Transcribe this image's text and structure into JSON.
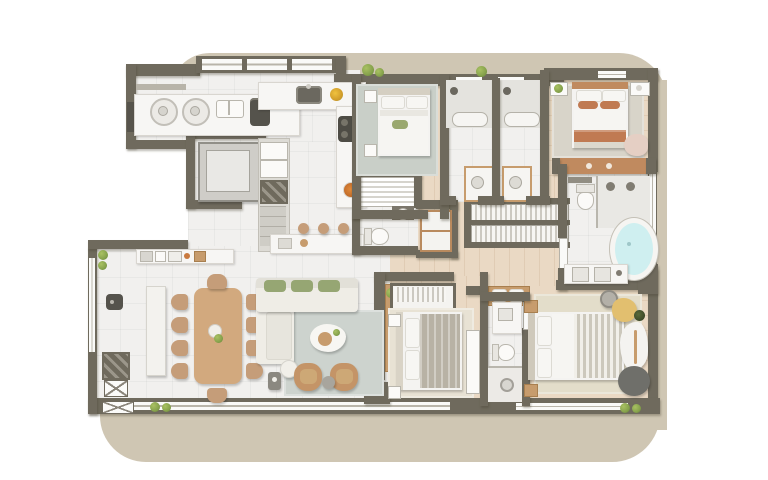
{
  "scene": {
    "type": "architectural-floor-plan",
    "view": "top-down 3d render",
    "description": "Rendered apartment floor plan on a beige rounded-corner backdrop",
    "visible_text": "none"
  },
  "palette": {
    "page_bg": "#ffffff",
    "card": "#cfc6b3",
    "wall": "#6f6a5d",
    "wall_dark": "#57544c",
    "floor_tile": "#f1f0ee",
    "wood": "#ead9c4",
    "counter": "#f7f6f4",
    "counter_line": "#d9d6d0",
    "glass": "#fafaf8",
    "window_frame": "#b9b5aa",
    "rug_gray": "#c9cfc8",
    "rug_warm": "#d8d4c9",
    "rug_beige": "#e3ddca",
    "rug_light": "#e8e2d4",
    "rug_living": "#cdd3ce",
    "sofa": "#efede6",
    "cushion_green": "#96a673",
    "wood_furn": "#d2a97e",
    "chair_tan": "#c59d79",
    "armchair": "#c49467",
    "terracotta": "#c07a52",
    "linen_white": "#f4f3f1",
    "blanket_gray": "#b8b2a5",
    "tub_water": "#cfeff0",
    "pouf_yellow": "#e2bf6f",
    "plant": "#86a24c",
    "plant_dark": "#5f7d35",
    "appliance_dark": "#55534c",
    "elevator": "#cfcdc8",
    "elevator_inner": "#e9e8e5",
    "blush": "#e5cfc4",
    "ottoman_dark": "#6f6f6a",
    "headboard_wood": "#c08a5f"
  },
  "rooms": [
    {
      "id": "laundry-service",
      "furniture": [
        "windows",
        "counter",
        "two washing machines",
        "utility sink",
        "dark appliance"
      ]
    },
    {
      "id": "kitchen",
      "furniture": [
        "sink counter",
        "cooktop",
        "tall cabinets",
        "service shaft",
        "island with stools",
        "fruit bowl"
      ]
    },
    {
      "id": "elevator-hall",
      "furniture": [
        "private elevator"
      ]
    },
    {
      "id": "living-dining",
      "furniture": [
        "dining table",
        "ten chairs",
        "sideboard",
        "l-sofa with green cushions",
        "rug",
        "organic coffee table",
        "two armchairs",
        "side tables",
        "buffet counter",
        "ducts"
      ]
    },
    {
      "id": "powder-room",
      "furniture": [
        "toilet",
        "sink"
      ]
    },
    {
      "id": "pantry",
      "furniture": [
        "wire shelving"
      ]
    },
    {
      "id": "corridor",
      "furniture": [
        "double clothes wardrobe",
        "linen cabinets"
      ]
    },
    {
      "id": "bedroom-1",
      "furniture": [
        "double bed",
        "gray rug",
        "nightstands"
      ]
    },
    {
      "id": "bathroom-1",
      "furniture": [
        "shower",
        "bench",
        "vanity"
      ]
    },
    {
      "id": "bathroom-2",
      "furniture": [
        "shower",
        "bench",
        "vanity"
      ]
    },
    {
      "id": "bedroom-2",
      "furniture": [
        "bed with terracotta bedding",
        "rug",
        "nightstands",
        "accent chair",
        "wardrobe"
      ]
    },
    {
      "id": "master-bathroom",
      "furniture": [
        "toilet",
        "double shower",
        "oval bathtub",
        "double vanity"
      ]
    },
    {
      "id": "master-bedroom",
      "furniture": [
        "king bed",
        "beige rug",
        "yellow pouf",
        "organic chaise",
        "round ottoman",
        "bench"
      ]
    },
    {
      "id": "bedroom-3",
      "furniture": [
        "bed",
        "wardrobe with clothes",
        "dresser",
        "rug",
        "nightstands"
      ]
    },
    {
      "id": "bathroom-3",
      "furniture": [
        "vanity",
        "toilet",
        "shower"
      ]
    }
  ]
}
